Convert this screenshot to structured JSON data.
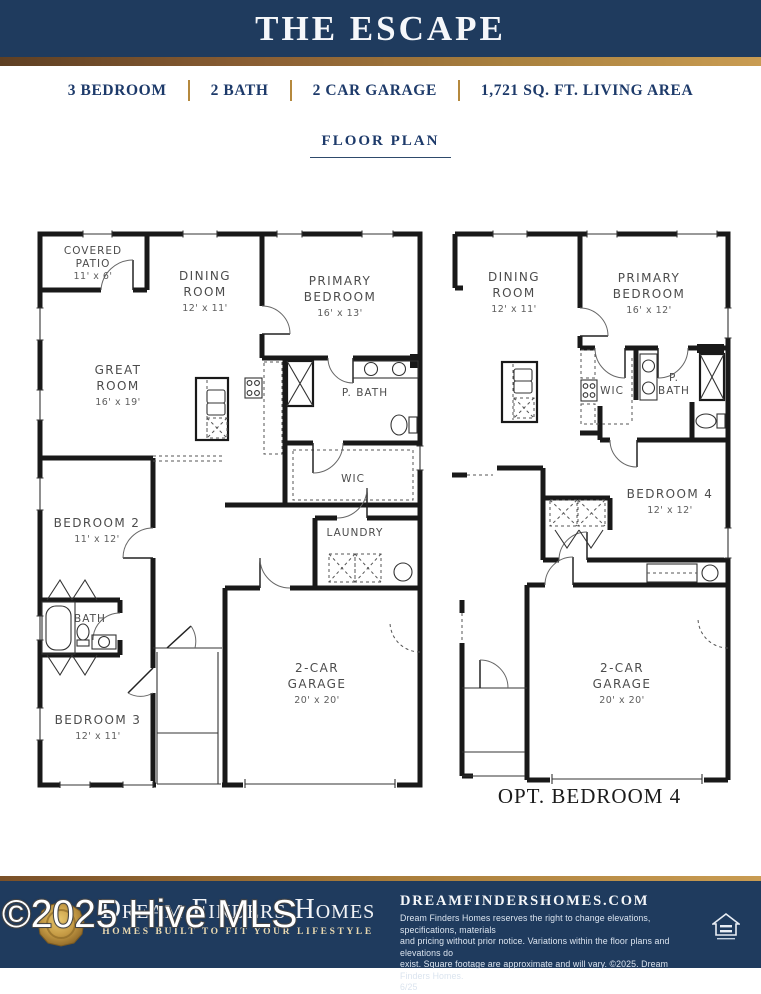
{
  "header": {
    "title": "THE ESCAPE"
  },
  "specs": {
    "items": [
      "3 BEDROOM",
      "2 BATH",
      "2 CAR GARAGE",
      "1,721 SQ. FT. LIVING AREA"
    ]
  },
  "section": {
    "title": "FLOOR PLAN"
  },
  "plans": {
    "main": {
      "rooms": {
        "patio": {
          "line1": "COVERED",
          "line2": "PATIO",
          "dims": "11' x 6'"
        },
        "dining": {
          "line1": "DINING",
          "line2": "ROOM",
          "dims": "12' x 11'"
        },
        "primary": {
          "line1": "PRIMARY",
          "line2": "BEDROOM",
          "dims": "16' x 13'"
        },
        "great": {
          "line1": "GREAT",
          "line2": "ROOM",
          "dims": "16' x 19'"
        },
        "pbath": {
          "label": "P. BATH"
        },
        "wic": {
          "label": "WIC"
        },
        "laundry": {
          "label": "LAUNDRY"
        },
        "bed2": {
          "line1": "BEDROOM 2",
          "dims": "11' x 12'"
        },
        "bath": {
          "label": "BATH"
        },
        "bed3": {
          "line1": "BEDROOM 3",
          "dims": "12' x 11'"
        },
        "garage": {
          "line1": "2-CAR",
          "line2": "GARAGE",
          "dims": "20' x 20'"
        }
      }
    },
    "option": {
      "caption": "OPT. BEDROOM 4",
      "rooms": {
        "dining": {
          "line1": "DINING",
          "line2": "ROOM",
          "dims": "12' x 11'"
        },
        "primary": {
          "line1": "PRIMARY",
          "line2": "BEDROOM",
          "dims": "16' x 12'"
        },
        "wic": {
          "label": "WIC"
        },
        "pbath": {
          "line1": "P.",
          "line2": "BATH"
        },
        "bed4": {
          "line1": "BEDROOM 4",
          "dims": "12' x 12'"
        },
        "garage": {
          "line1": "2-CAR",
          "line2": "GARAGE",
          "dims": "20' x 20'"
        }
      }
    }
  },
  "footer": {
    "brand": "Dream Finders Homes",
    "tagline": "HOMES BUILT TO FIT YOUR LIFESTYLE",
    "website": "DREAMFINDERSHOMES.COM",
    "disclaimer_lines": [
      "Dream Finders Homes reserves the right to change elevations, specifications, materials",
      "and pricing without prior notice. Variations within the floor plans and elevations do",
      "exist. Square footage are approximate and will vary. ©2025. Dream Finders Homes.",
      "6/25"
    ]
  },
  "watermark": "©2025 Hive MLS",
  "colors": {
    "navy": "#1f3b5e",
    "gold": "#b5893e",
    "text_navy": "#1d3a6a",
    "wall": "#191919"
  }
}
